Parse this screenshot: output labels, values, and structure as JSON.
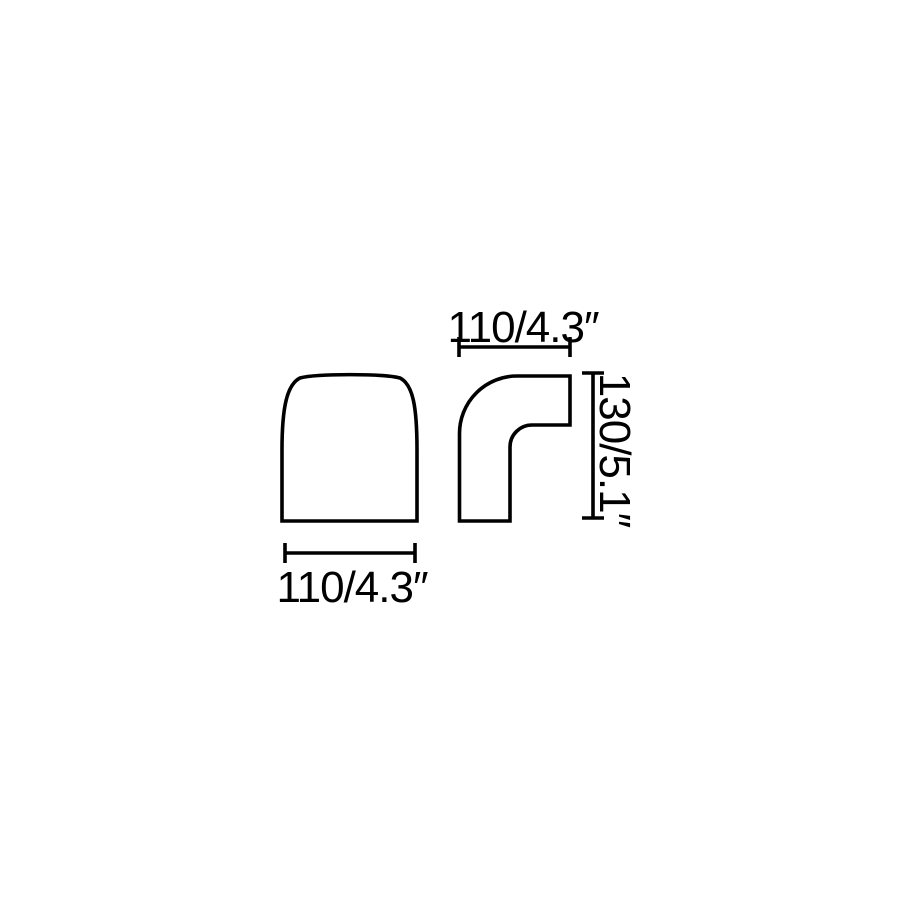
{
  "canvas": {
    "background": "#ffffff",
    "line_color": "#000000"
  },
  "diagram": {
    "kind": "technical-dimension-drawing",
    "views": [
      {
        "id": "front-view"
      },
      {
        "id": "side-view"
      }
    ],
    "dimensions": {
      "side_width_top": {
        "label": "110/4.3″",
        "mm": 110,
        "inches": 4.3
      },
      "side_height_right": {
        "label": "130/5.1″",
        "mm": 130,
        "inches": 5.1
      },
      "front_width_bottom": {
        "label": "110/4.3″",
        "mm": 110,
        "inches": 4.3
      }
    }
  }
}
